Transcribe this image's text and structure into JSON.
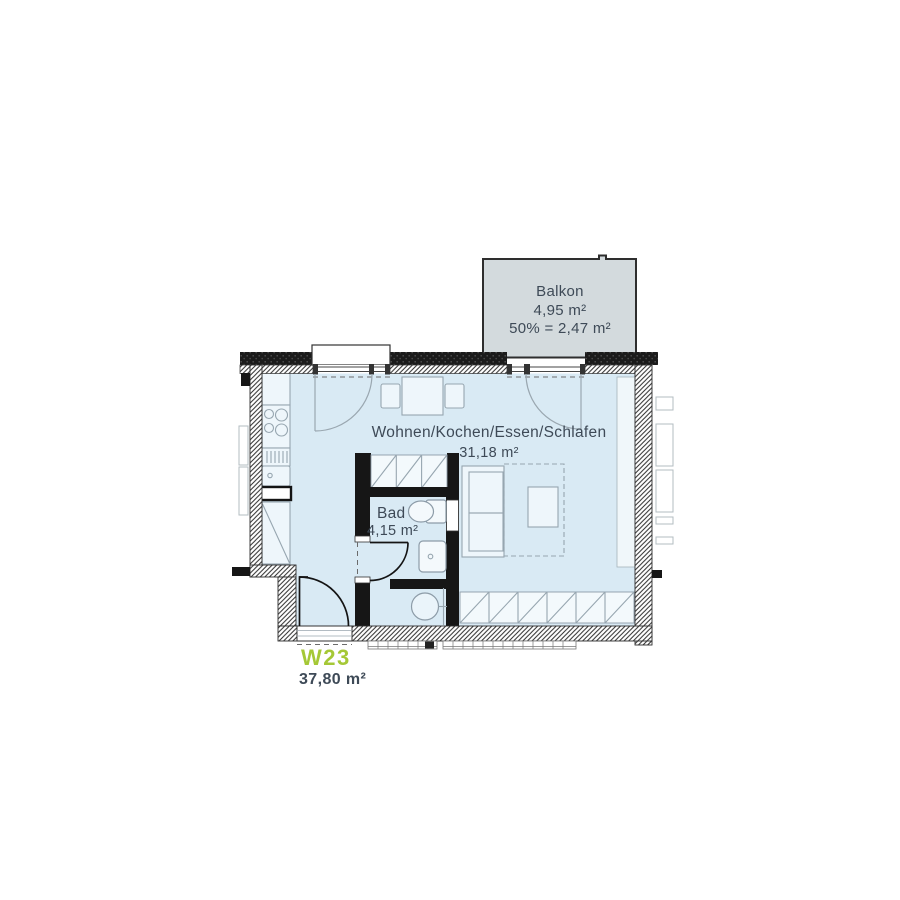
{
  "unit": {
    "id": "W23",
    "total_area": "37,80 m²"
  },
  "rooms": [
    {
      "name": "Balkon",
      "area": "4,95 m²",
      "note": "50% = 2,47 m²"
    },
    {
      "name": "Wohnen/Kochen/Essen/Schlafen",
      "area": "31,18 m²"
    },
    {
      "name": "Bad",
      "area": "4,15 m²"
    }
  ],
  "colors": {
    "accent_green": "#a5c836",
    "room_fill": "#d9eaf4",
    "balcony_fill": "#d3dadd",
    "label_text": "#3e4a57",
    "wall_black": "#161616"
  }
}
